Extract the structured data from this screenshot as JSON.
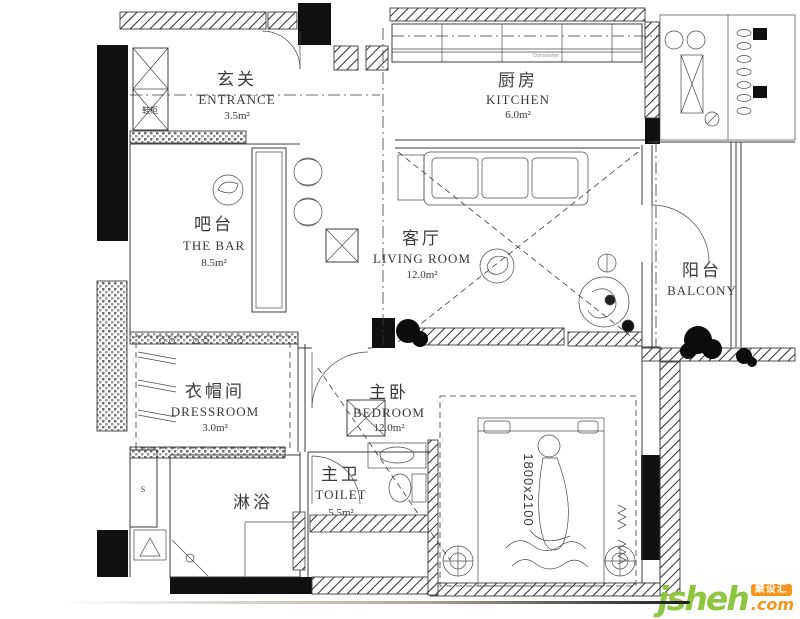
{
  "plan": {
    "rooms": {
      "entrance": {
        "cn": "玄关",
        "en": "ENTRANCE",
        "area": "3.5m²"
      },
      "kitchen": {
        "cn": "厨房",
        "en": "KITCHEN",
        "area": "6.0m²"
      },
      "bar": {
        "cn": "吧台",
        "en": "THE BAR",
        "area": "8.5m²"
      },
      "living_room": {
        "cn": "客厅",
        "en": "LIVING ROOM",
        "area": "12.0m²"
      },
      "balcony": {
        "cn": "阳台",
        "en": "BALCONY"
      },
      "dressroom": {
        "cn": "衣帽间",
        "en": "DRESSROOM",
        "area": "3.0m²"
      },
      "bedroom": {
        "cn": "主卧",
        "en": "BEDROOM",
        "area": "12.0m²"
      },
      "toilet": {
        "cn": "主卫",
        "en": "TOILET",
        "area": "5.5m²"
      },
      "shower": {
        "cn": "淋浴"
      },
      "shoe_cabinet": {
        "cn": "鞋柜"
      }
    },
    "annotations": {
      "bed_size": "1800x2100",
      "s_marker": "S",
      "appliance_label": "Dishwasher"
    },
    "line_color": "#3b3b3b"
  },
  "watermark": {
    "brand": "jsheh",
    "tld": ".com",
    "badge": "聚设汇",
    "brand_color": "#8dc63f",
    "accent_color": "#f7941d"
  }
}
